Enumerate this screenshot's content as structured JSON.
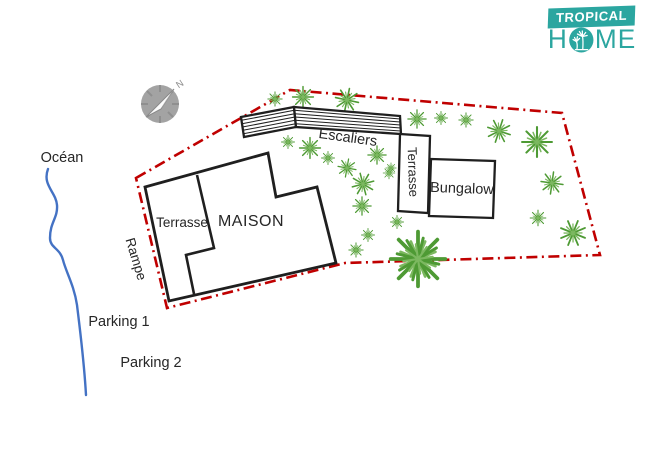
{
  "logo": {
    "line1": "TROPICAL",
    "line2": "HOME",
    "line2_parts": {
      "h": "H",
      "me": "ME"
    }
  },
  "colors": {
    "teal": "#2BA6A0",
    "boundary_red": "#C00000",
    "plant_green": "#4E9A34",
    "plant_green_dark": "#2E7D1E",
    "plant_green_light": "#7CB860",
    "ocean_blue": "#4472C4",
    "ink": "#262626",
    "building_stroke": "#1F1F1F",
    "compass_gray": "#A3A3A3"
  },
  "plan": {
    "labels": {
      "ocean": "Océan",
      "maison": "MAISON",
      "terrace_house": "Terrasse",
      "stairs": "Escaliers",
      "terrace_bungalow": "Terrasse",
      "bungalow": "Bungalow",
      "ramp": "Rampe",
      "parking1": "Parking 1",
      "parking2": "Parking 2",
      "north": "N"
    }
  }
}
